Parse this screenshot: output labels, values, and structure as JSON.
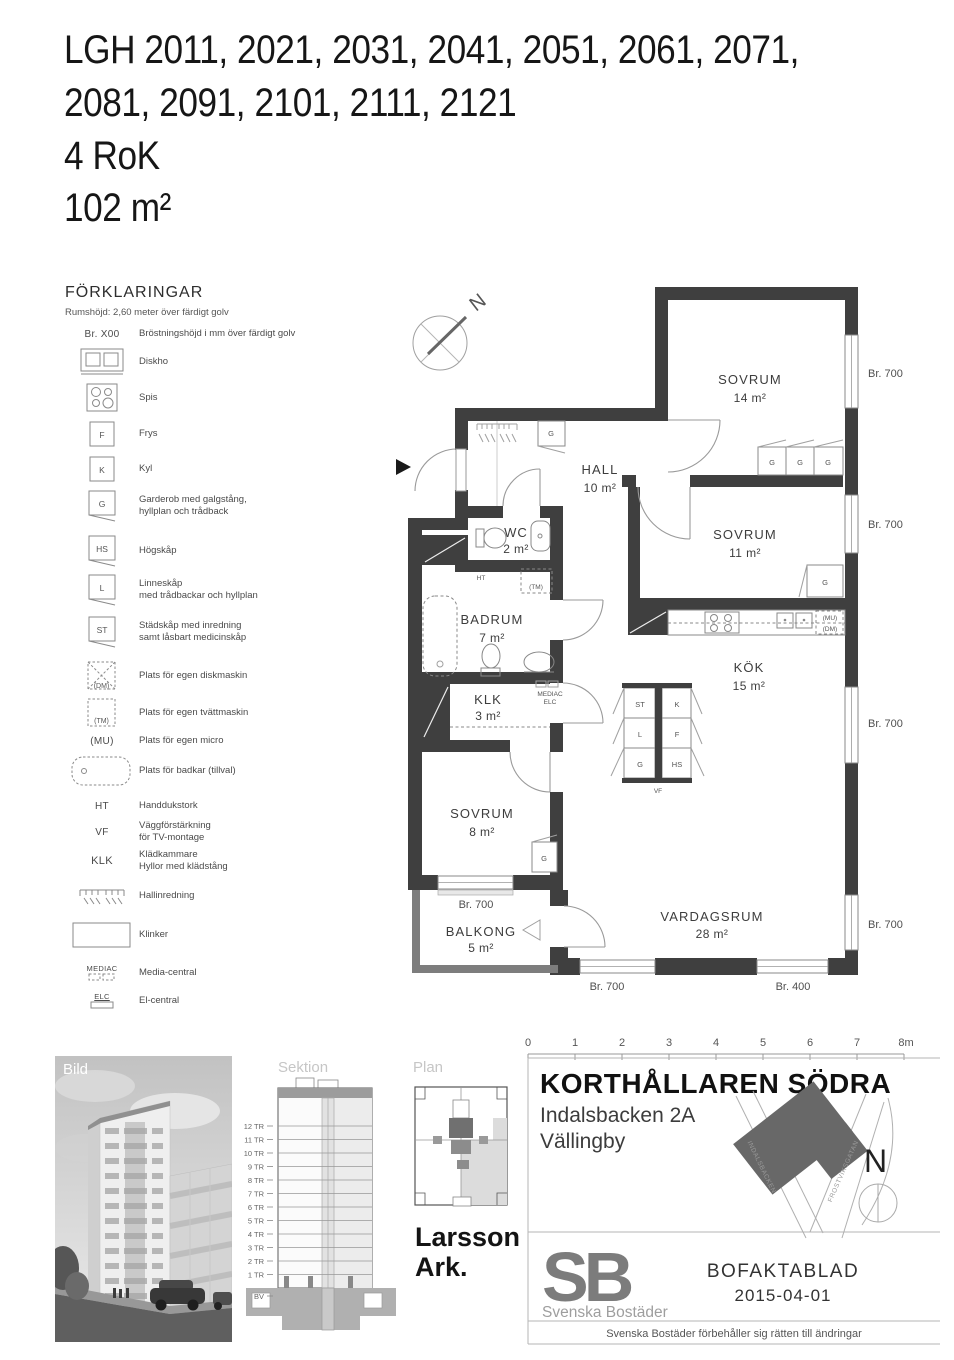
{
  "title": {
    "line1": "LGH 2011, 2021, 2031, 2041, 2051, 2061, 2071,",
    "line2": "2081, 2091, 2101, 2111, 2121",
    "line3": "4 RoK",
    "line4": "102 m²"
  },
  "legend": {
    "heading": "FÖRKLARINGAR",
    "subheading": "Rumshöjd: 2,60 meter över färdigt golv",
    "items": [
      {
        "sym": "Br. X00",
        "label": "Bröstningshöjd i mm över färdigt golv"
      },
      {
        "sym": "",
        "label": "Diskho"
      },
      {
        "sym": "",
        "label": "Spis"
      },
      {
        "sym": "F",
        "label": "Frys"
      },
      {
        "sym": "K",
        "label": "Kyl"
      },
      {
        "sym": "G",
        "label": "Garderob med galgstång,\nhyllplan och trådback"
      },
      {
        "sym": "HS",
        "label": "Högskåp"
      },
      {
        "sym": "L",
        "label": "Linneskåp\nmed trådbackar och hyllplan"
      },
      {
        "sym": "ST",
        "label": "Städskåp med inredning\nsamt låsbart medicinskåp"
      },
      {
        "sym": "(DM)",
        "label": "Plats för egen diskmaskin"
      },
      {
        "sym": "(TM)",
        "label": "Plats för egen tvättmaskin"
      },
      {
        "sym": "(MU)",
        "label": "Plats för egen micro"
      },
      {
        "sym": "",
        "label": "Plats för badkar (tillval)"
      },
      {
        "sym": "HT",
        "label": "Handdukstork"
      },
      {
        "sym": "VF",
        "label": "Väggförstärkning\nför TV-montage"
      },
      {
        "sym": "KLK",
        "label": "Klädkammare\nHyllor med klädstång"
      },
      {
        "sym": "",
        "label": "Hallinredning"
      },
      {
        "sym": "",
        "label": "Klinker"
      },
      {
        "sym": "MEDIAC",
        "label": "Media-central"
      },
      {
        "sym": "ELC",
        "label": "El-central"
      }
    ]
  },
  "plan": {
    "north": "N",
    "rooms": [
      {
        "name": "SOVRUM",
        "area": "14 m²"
      },
      {
        "name": "SOVRUM",
        "area": "11 m²"
      },
      {
        "name": "HALL",
        "area": "10 m²"
      },
      {
        "name": "WC",
        "area": "2 m²"
      },
      {
        "name": "BADRUM",
        "area": "7 m²"
      },
      {
        "name": "KLK",
        "area": "3 m²"
      },
      {
        "name": "KÖK",
        "area": "15 m²"
      },
      {
        "name": "SOVRUM",
        "area": "8 m²"
      },
      {
        "name": "BALKONG",
        "area": "5 m²"
      },
      {
        "name": "VARDAGSRUM",
        "area": "28 m²"
      }
    ],
    "br": [
      "Br. 700",
      "Br. 700",
      "Br. 700",
      "Br. 700",
      "Br. 700",
      "Br. 700",
      "Br. 400"
    ],
    "markers": {
      "g": "G",
      "st": "ST",
      "l": "L",
      "k": "K",
      "f": "F",
      "hs": "HS",
      "vf": "VF",
      "ht": "HT",
      "tm": "(TM)",
      "mu": "(MU)",
      "dm": "(DM)",
      "mediac": "MEDIAC",
      "elc": "ELC"
    }
  },
  "footer": {
    "bild_label": "Bild",
    "sektion_label": "Sektion",
    "plan_label": "Plan",
    "architect": "Larsson\nArk.",
    "floors": [
      "12 TR",
      "11 TR",
      "10 TR",
      "9 TR",
      "8 TR",
      "7 TR",
      "6 TR",
      "5 TR",
      "4 TR",
      "3 TR",
      "2 TR",
      "1 TR",
      "BV"
    ],
    "scale_ticks": [
      "0",
      "1",
      "2",
      "3",
      "4",
      "5",
      "6",
      "7",
      "8m"
    ],
    "project": "KORTHÅLLAREN SÖDRA",
    "address_line1": "Indalsbacken 2A",
    "address_line2": "Vällingby",
    "map": {
      "street1": "INDALSBACKEN",
      "street2": "FROSTVIKSGATAN",
      "north": "N"
    },
    "logo": {
      "mark": "SB",
      "name": "Svenska Bostäder"
    },
    "doc_type": "BOFAKTABLAD",
    "doc_date": "2015-04-01",
    "disclaimer": "Svenska Bostäder förbehåller sig rätten till ändringar"
  }
}
